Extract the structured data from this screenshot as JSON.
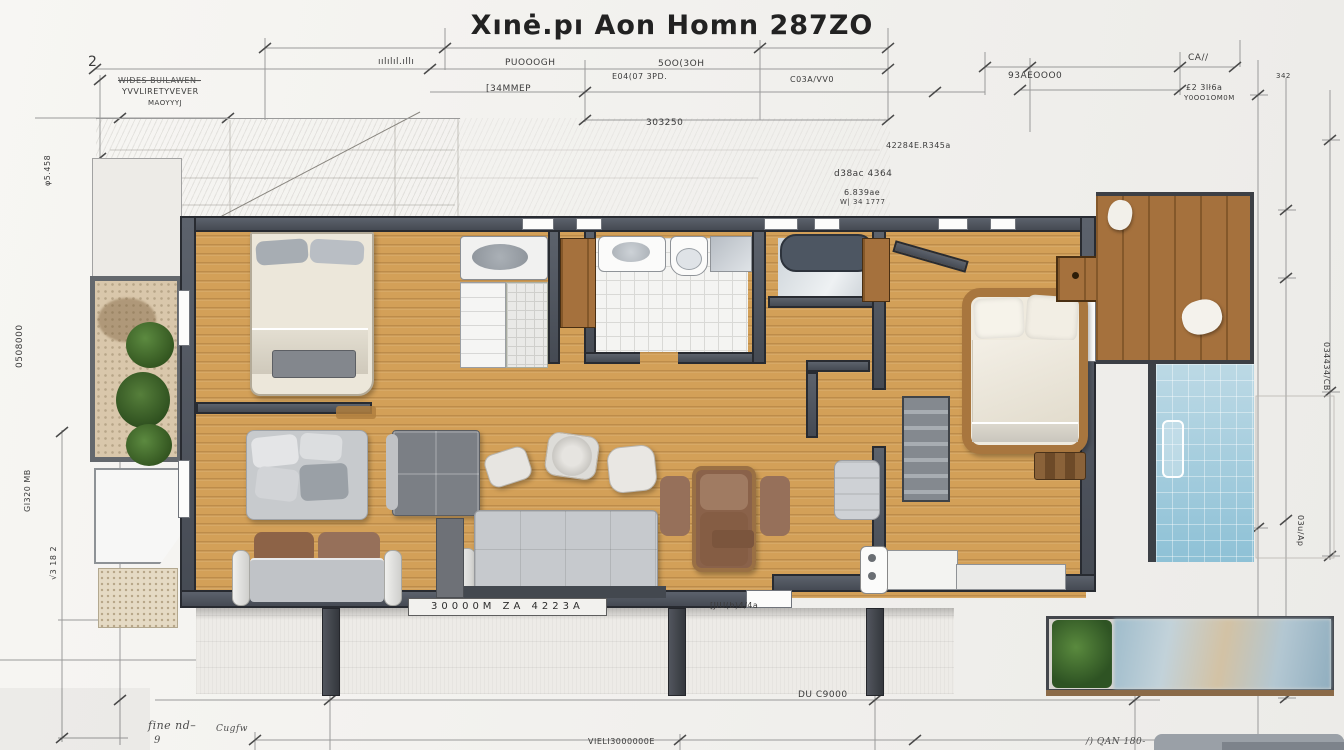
{
  "title": "Xınė.pı  Aon Homn 287ZO",
  "palette": {
    "paper": "#f2f1ee",
    "ink": "#2e2e2e",
    "wall_gray": "#4e545e",
    "wood_floor": "#d3a058",
    "deck_wood": "#a5713d",
    "bath_tile": "#f4f4f2",
    "pool_blue": "#8ec1d6",
    "garden_gravel": "#d9c7ab",
    "shrub_green": "#4c7a38",
    "sofa_gray": "#c6c9cd",
    "leather_brown": "#8a624a",
    "bed_linen": "#efeade"
  },
  "annotations": [
    {
      "text": "2",
      "x": 88,
      "y": 55,
      "s": 14
    },
    {
      "text": "ıılılıl.ıllı",
      "x": 378,
      "y": 58,
      "s": 9
    },
    {
      "text": "WIĐES BUILAWEN–",
      "x": 118,
      "y": 77,
      "s": 8,
      "cls": "strike"
    },
    {
      "text": "YVVLIRETYVEVER",
      "x": 122,
      "y": 88,
      "s": 8
    },
    {
      "text": "MAOYYYJ",
      "x": 148,
      "y": 100,
      "s": 7
    },
    {
      "text": "PUOOOGH",
      "x": 505,
      "y": 59,
      "s": 9
    },
    {
      "text": "5OO(3OH",
      "x": 658,
      "y": 60,
      "s": 9
    },
    {
      "text": "E04(07 3PD.",
      "x": 612,
      "y": 73,
      "s": 8
    },
    {
      "text": "[34MMEP",
      "x": 486,
      "y": 85,
      "s": 9
    },
    {
      "text": "C03A/VV0",
      "x": 790,
      "y": 76,
      "s": 8
    },
    {
      "text": "93AEOOO0",
      "x": 1008,
      "y": 72,
      "s": 9
    },
    {
      "text": "CA//",
      "x": 1188,
      "y": 54,
      "s": 9
    },
    {
      "text": "£2 3Ił6a",
      "x": 1186,
      "y": 84,
      "s": 8
    },
    {
      "text": "Y0OO1OM0M",
      "x": 1184,
      "y": 95,
      "s": 7
    },
    {
      "text": "342",
      "x": 1276,
      "y": 73,
      "s": 7
    },
    {
      "text": "303250",
      "x": 646,
      "y": 119,
      "s": 9
    },
    {
      "text": "42284E.R345a",
      "x": 886,
      "y": 142,
      "s": 8
    },
    {
      "text": "d38ac 4364",
      "x": 834,
      "y": 170,
      "s": 9
    },
    {
      "text": "6.839ae",
      "x": 844,
      "y": 189,
      "s": 8
    },
    {
      "text": "W| 34 1777",
      "x": 840,
      "y": 199,
      "s": 7
    },
    {
      "text": "φ5.458",
      "x": 44,
      "y": 186,
      "s": 8,
      "r": -90
    },
    {
      "text": "0508000",
      "x": 16,
      "y": 368,
      "s": 9,
      "r": -90
    },
    {
      "text": "GI320 MB",
      "x": 24,
      "y": 512,
      "s": 8,
      "r": -90
    },
    {
      "text": "√3 18 2",
      "x": 50,
      "y": 580,
      "s": 8,
      "r": -90
    },
    {
      "text": "034434/CB",
      "x": 1330,
      "y": 342,
      "s": 8,
      "r": 90
    },
    {
      "text": "03u/Ap",
      "x": 1304,
      "y": 515,
      "s": 8,
      "r": 90
    },
    {
      "text": "30000M ZA 4223A",
      "x": 408,
      "y": 598,
      "s": 10,
      "cls": "plaque"
    },
    {
      "text": "[JIU(b)4/4a",
      "x": 710,
      "y": 602,
      "s": 8
    },
    {
      "text": "DU C9000",
      "x": 798,
      "y": 691,
      "s": 9
    },
    {
      "text": "VIELI3000000E",
      "x": 588,
      "y": 738,
      "s": 8
    },
    {
      "text": "fine nd–",
      "x": 148,
      "y": 720,
      "s": 11,
      "cls": "script"
    },
    {
      "text": "9",
      "x": 154,
      "y": 736,
      "s": 10,
      "cls": "script"
    },
    {
      "text": "Cugfw",
      "x": 216,
      "y": 725,
      "s": 9,
      "cls": "script"
    },
    {
      "text": "/) QAN 180-",
      "x": 1086,
      "y": 738,
      "s": 9,
      "cls": "script"
    }
  ]
}
